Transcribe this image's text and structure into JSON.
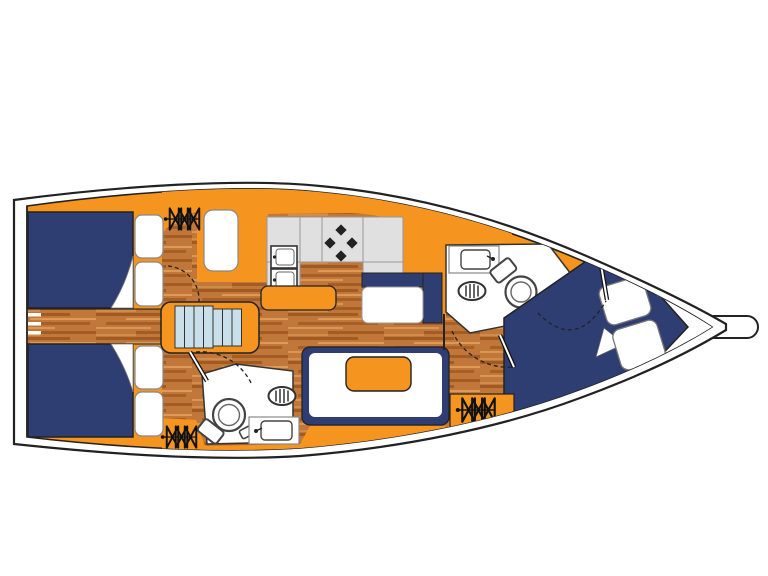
{
  "diagram": {
    "type": "yacht-deck-plan",
    "description": "top-down interior layout plan of a sailing monohull, bow pointing right",
    "background": "#ffffff"
  },
  "colors": {
    "hull_line": "#1f1f1f",
    "deck_orange": "#f5941f",
    "berth_navy": "#2e3d72",
    "wood_base": "#c1773a",
    "wood_dark": "#9a561f",
    "wood_light": "#dd9a55",
    "counter_gray": "#dfe0df",
    "counter_edge": "#909090",
    "stair_blue": "#c9dfe9",
    "fixture_white": "#ffffff",
    "soft_outline": "#666666"
  },
  "elements": {
    "rooms": [
      "aft-port-cabin",
      "aft-starboard-cabin",
      "aft-head",
      "saloon",
      "galley",
      "forward-head",
      "forward-cabin"
    ],
    "icons": [
      "hull",
      "transom",
      "bowsprit",
      "swim-ladder",
      "double-berth",
      "pillow",
      "hatch",
      "companionway-stairs",
      "galley-counter",
      "double-sink",
      "stove-burners",
      "kitchen-island",
      "settee",
      "dinette-table",
      "u-settee",
      "toilet",
      "shower-drain",
      "washbasin",
      "door-swing",
      "bow-locker"
    ]
  }
}
